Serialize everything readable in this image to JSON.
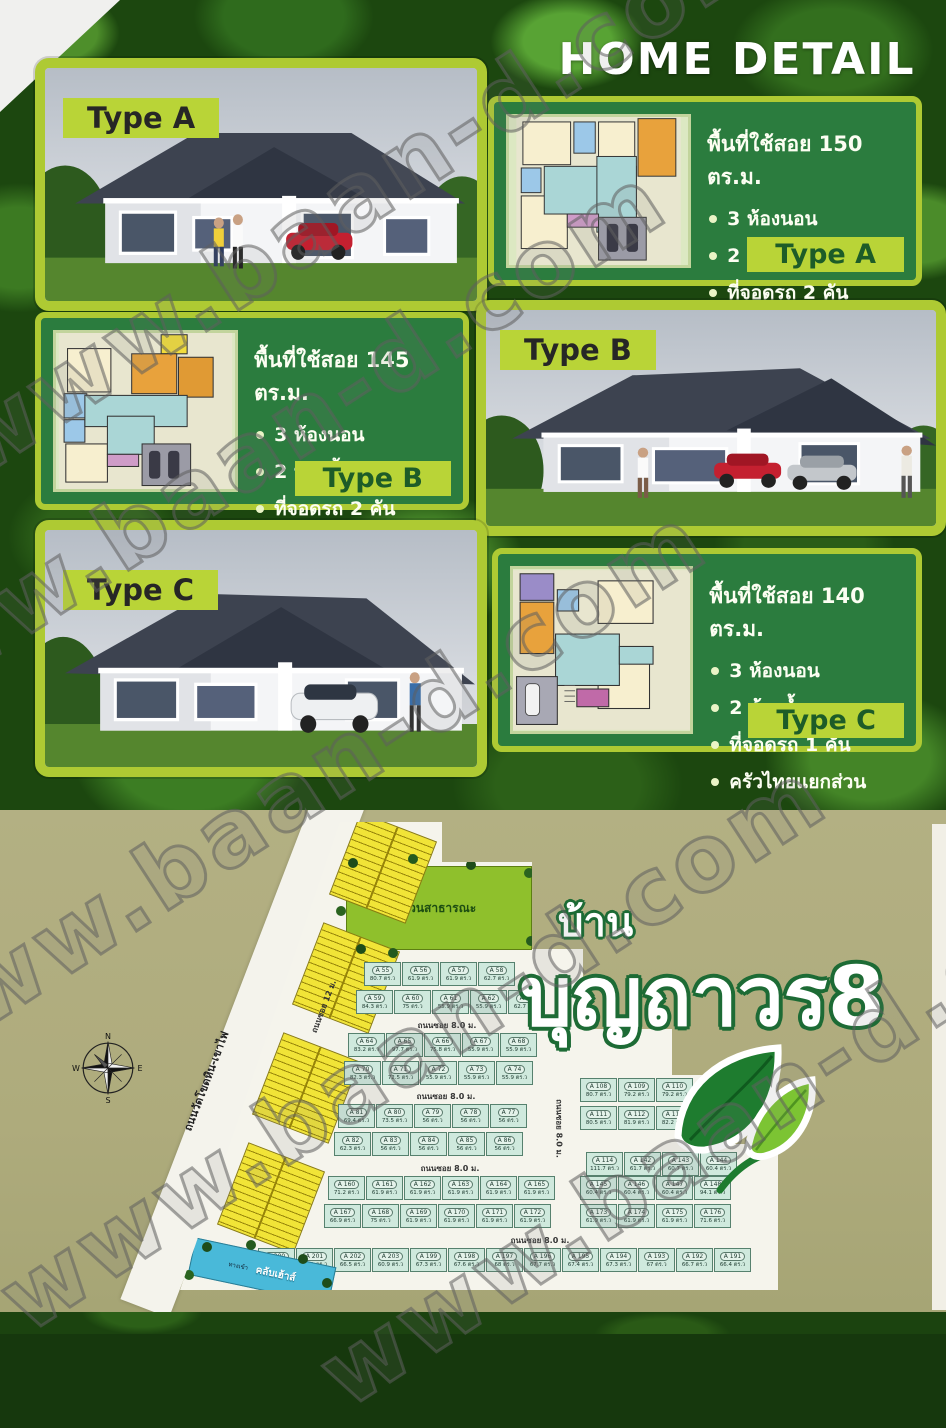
{
  "watermark": {
    "text": "www.baan-d.com"
  },
  "page": {
    "title": "HOME DETAIL"
  },
  "house_types": [
    {
      "label": "Type A",
      "area_text": "พื้นที่ใช้สอย 150 ตร.ม.",
      "features": [
        "3 ห้องนอน",
        "2 ห้องน้ำ",
        "ที่จอดรถ 2 คัน",
        "ครัวไทยแยกส่วน"
      ]
    },
    {
      "label": "Type B",
      "area_text": "พื้นที่ใช้สอย 145 ตร.ม.",
      "features": [
        "3 ห้องนอน",
        "2 ห้องน้ำ",
        "ที่จอดรถ 2 คัน",
        "ครัวไทยแยกส่วน"
      ]
    },
    {
      "label": "Type C",
      "area_text": "พื้นที่ใช้สอย 140 ตร.ม.",
      "features": [
        "3 ห้องนอน",
        "2 ห้องน้ำ",
        "ที่จอดรถ 1 คัน",
        "ครัวไทยแยกส่วน"
      ]
    }
  ],
  "branding": {
    "prefix": "บ้าน",
    "name": "บุญถาวร8"
  },
  "site_plan": {
    "compass": {
      "north": "N",
      "east": "E",
      "south": "S",
      "west": "W"
    },
    "main_road": "ถนนวัดโขดหิน-เขาไฟ",
    "soi_road_12": "ถนนซอย 12 ม.",
    "soi_road_8": "ถนนซอย 8.0 ม.",
    "park_label": "สวนสาธารณะ",
    "entrance_label": "ทางเข้า",
    "clubhouse_label": "คลับเฮ้าส์",
    "rows": [
      [
        {
          "id": "A 55",
          "area": "80.7 ตร.ว"
        },
        {
          "id": "A 56",
          "area": "61.9 ตร.ว"
        },
        {
          "id": "A 57",
          "area": "61.9 ตร.ว"
        },
        {
          "id": "A 58",
          "area": "62.7 ตร.ว"
        }
      ],
      [
        {
          "id": "A 59",
          "area": "84.3 ตร.ว"
        },
        {
          "id": "A 60",
          "area": "75 ตร.ว"
        },
        {
          "id": "A 61",
          "area": "55.9 ตร.ว"
        },
        {
          "id": "A 62",
          "area": "55.9 ตร.ว"
        },
        {
          "id": "A 63",
          "area": "62.7 ตร.ว"
        }
      ],
      [
        {
          "id": "A 64",
          "area": "83.2 ตร.ว"
        },
        {
          "id": "A 65",
          "area": "97.7 ตร.ว"
        },
        {
          "id": "A 66",
          "area": "75.8 ตร.ว"
        },
        {
          "id": "A 67",
          "area": "55.9 ตร.ว"
        },
        {
          "id": "A 68",
          "area": "55.9 ตร.ว"
        }
      ],
      [
        {
          "id": "A 70",
          "area": "82.3 ตร.ว"
        },
        {
          "id": "A 71",
          "area": "72.5 ตร.ว"
        },
        {
          "id": "A 72",
          "area": "55.9 ตร.ว"
        },
        {
          "id": "A 73",
          "area": "55.9 ตร.ว"
        },
        {
          "id": "A 74",
          "area": "55.9 ตร.ว"
        }
      ],
      [
        {
          "id": "A 81",
          "area": "69.4 ตร.ว"
        },
        {
          "id": "A 80",
          "area": "73.5 ตร.ว"
        },
        {
          "id": "A 79",
          "area": "56 ตร.ว"
        },
        {
          "id": "A 78",
          "area": "56 ตร.ว"
        },
        {
          "id": "A 77",
          "area": "56 ตร.ว"
        }
      ],
      [
        {
          "id": "A 82",
          "area": "62.3 ตร.ว"
        },
        {
          "id": "A 83",
          "area": "56 ตร.ว"
        },
        {
          "id": "A 84",
          "area": "56 ตร.ว"
        },
        {
          "id": "A 85",
          "area": "56 ตร.ว"
        },
        {
          "id": "A 86",
          "area": "56 ตร.ว"
        }
      ],
      [
        {
          "id": "A 108",
          "area": "80.7 ตร.ว"
        },
        {
          "id": "A 109",
          "area": "79.2 ตร.ว"
        },
        {
          "id": "A 110",
          "area": "79.2 ตร.ว"
        }
      ],
      [
        {
          "id": "A 111",
          "area": "80.5 ตร.ว"
        },
        {
          "id": "A 112",
          "area": "81.9 ตร.ว"
        },
        {
          "id": "A 113",
          "area": "82.2 ตร.ว"
        }
      ],
      [
        {
          "id": "A 114",
          "area": "111.7 ตร.ว"
        },
        {
          "id": "A 142",
          "area": "61.7 ตร.ว"
        },
        {
          "id": "A 143",
          "area": "60.7 ตร.ว"
        },
        {
          "id": "A 144",
          "area": "60.4 ตร.ว"
        }
      ],
      [
        {
          "id": "A 160",
          "area": "71.2 ตร.ว"
        },
        {
          "id": "A 161",
          "area": "61.9 ตร.ว"
        },
        {
          "id": "A 162",
          "area": "61.9 ตร.ว"
        },
        {
          "id": "A 163",
          "area": "61.9 ตร.ว"
        },
        {
          "id": "A 164",
          "area": "61.9 ตร.ว"
        },
        {
          "id": "A 165",
          "area": "61.9 ตร.ว"
        }
      ],
      [
        {
          "id": "A 145",
          "area": "60.4 ตร.ว"
        },
        {
          "id": "A 146",
          "area": "60.4 ตร.ว"
        },
        {
          "id": "A 147",
          "area": "60.4 ตร.ว"
        },
        {
          "id": "A 148",
          "area": "94.1 ตร.ว"
        }
      ],
      [
        {
          "id": "A 167",
          "area": "66.9 ตร.ว"
        },
        {
          "id": "A 168",
          "area": "75 ตร.ว"
        },
        {
          "id": "A 169",
          "area": "61.9 ตร.ว"
        },
        {
          "id": "A 170",
          "area": "61.9 ตร.ว"
        },
        {
          "id": "A 171",
          "area": "61.9 ตร.ว"
        },
        {
          "id": "A 172",
          "area": "61.9 ตร.ว"
        }
      ],
      [
        {
          "id": "A 173",
          "area": "61.9 ตร.ว"
        },
        {
          "id": "A 174",
          "area": "61.9 ตร.ว"
        },
        {
          "id": "A 175",
          "area": "61.9 ตร.ว"
        },
        {
          "id": "A 176",
          "area": "71.6 ตร.ว"
        }
      ],
      [
        {
          "id": "A 200",
          "area": "65.7 ตร.ว"
        },
        {
          "id": "A 201",
          "area": "65.1 ตร.ว"
        },
        {
          "id": "A 202",
          "area": "66.5 ตร.ว"
        },
        {
          "id": "A 203",
          "area": "60.9 ตร.ว"
        },
        {
          "id": "A 199",
          "area": "67.3 ตร.ว"
        },
        {
          "id": "A 198",
          "area": "67.6 ตร.ว"
        },
        {
          "id": "A 197",
          "area": "68 ตร.ว"
        },
        {
          "id": "A 196",
          "area": "67.7 ตร.ว"
        },
        {
          "id": "A 195",
          "area": "67.4 ตร.ว"
        },
        {
          "id": "A 194",
          "area": "67.3 ตร.ว"
        },
        {
          "id": "A 193",
          "area": "67 ตร.ว"
        },
        {
          "id": "A 192",
          "area": "66.7 ตร.ว"
        },
        {
          "id": "A 191",
          "area": "66.4 ตร.ว"
        }
      ]
    ]
  }
}
